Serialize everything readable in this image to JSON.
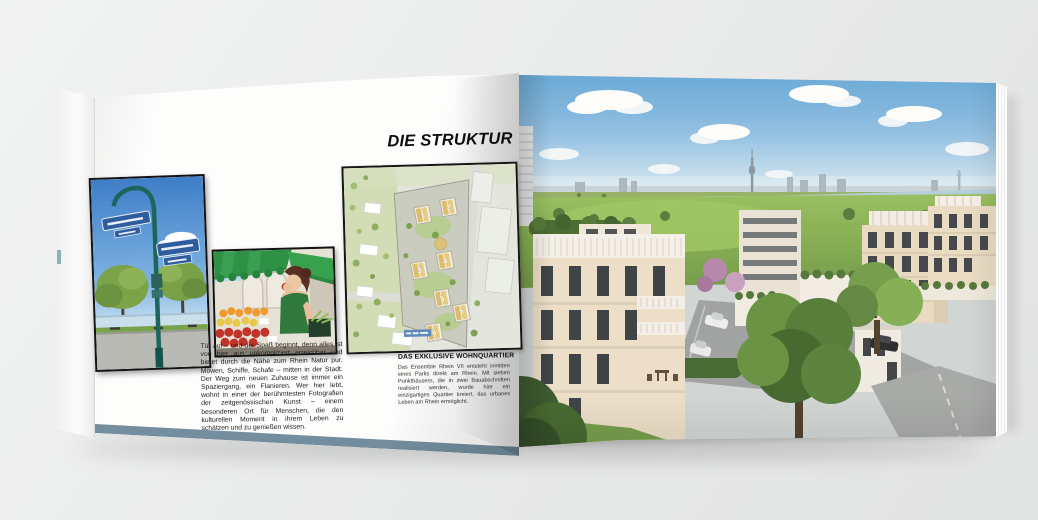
{
  "scene": {
    "background_color": "#eaebeb",
    "subject": "Aufgeschlagene Immobilien-Broschüre (Doppelseite)"
  },
  "left_page": {
    "headline": "DIE STRUKTUR",
    "body_text": "Tür auf – und der Spaß beginnt, denn alles ist von hier aus unkompliziert erreichbar und bietet durch die Nähe zum Rhein Natur pur. Möwen, Schiffe, Schafe – mitten in der Stadt. Der Weg zum neuen Zuhause ist immer ein Spaziergang, ein Flanieren. Wer hier lebt, wohnt in einer der berühmtesten Fotografien der zeitgenössischen Kunst – einem besonderen Ort für Menschen, die den kulturellen Moment in ihrem Leben zu schätzen und zu genießen wissen.",
    "caption_title": "DAS EXKLUSIVE WOHNQUARTIER",
    "caption_text": "Das Ensemble Rhein VII entsteht inmitten eines Parks direkt am Rhein. Mit sieben Punkthäusern, die in zwei Bauabschnitten realisiert werden, wurde hier ein einzigartiges Quartier kreiert, das urbanes Leben am Rhein ermöglicht.",
    "photos": {
      "street_sign_alt": "Straßenschild an der Rheinpromenade",
      "market_alt": "Frau am Obststand auf dem Wochenmarkt",
      "site_plan_alt": "Lageplan des Quartiers mit nummerierten Punkthäusern"
    },
    "site_plan_numbers": [
      "1",
      "2",
      "3",
      "4",
      "5",
      "6",
      "7"
    ]
  },
  "right_page": {
    "photo_alt": "Visualisierung: Wohnquartier am Rhein mit Düsseldorfer Skyline und Rheinturm"
  },
  "colors": {
    "page_white": "#fdfdfc",
    "cover_edge_blue": "#7f99a7",
    "headline_black": "#0e0e0e",
    "sky_blue": "#5aa3d8",
    "river_blue": "#b5cfdf",
    "meadow_green": "#84af51",
    "building_beige": "#ebdfca",
    "awning_green": "#2f9145",
    "street_sign_blue": "#2e5c9e",
    "pole_teal": "#1c655c",
    "map_green": "#d2ddb6",
    "map_roof_tan": "#dfc178",
    "map_label_blue": "#5d89b8"
  }
}
